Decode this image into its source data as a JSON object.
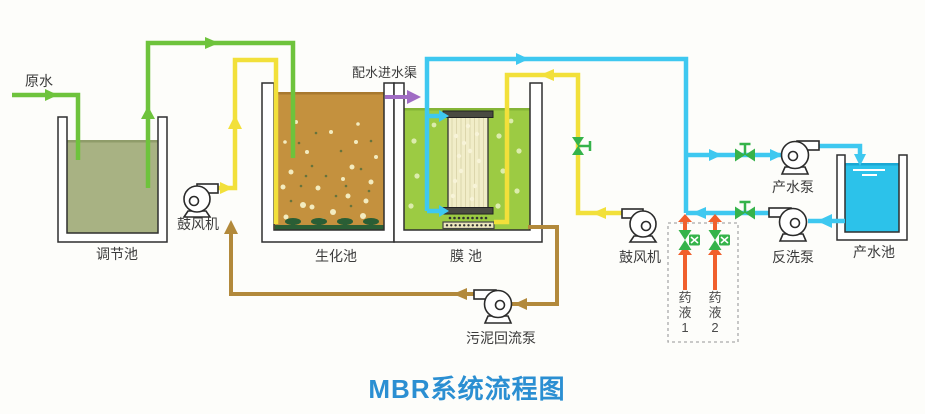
{
  "title": "MBR系统流程图",
  "labels": {
    "raw_water": "原水",
    "inlet_channel": "配水进水渠",
    "regulation_tank": "调节池",
    "blower_left": "鼓风机",
    "biochemical_tank": "生化池",
    "membrane_tank": "膜 池",
    "sludge_return_pump": "污泥回流泵",
    "blower_right": "鼓风机",
    "product_pump": "产水泵",
    "backwash_pump": "反洗泵",
    "product_tank": "产水池",
    "chemical_1": [
      "药",
      "液",
      "1"
    ],
    "chemical_2": [
      "药",
      "液",
      "2"
    ]
  },
  "colors": {
    "raw_water_pipe": "#6ec33c",
    "air_pipe": "#f2e03a",
    "permeate_pipe": "#3ec8f0",
    "sludge_pipe": "#b2893b",
    "chemical_pipe": "#f15f2c",
    "inlet_arrow": "#a06cc4",
    "valve": "#35b34a",
    "regulation_tank_fill": "#a8b283",
    "biochemical_tank_fill": "#c4913e",
    "membrane_tank_fill": "#9ccb43",
    "product_tank_fill": "#2cc2ea",
    "title_text": "#2b8fd2"
  }
}
